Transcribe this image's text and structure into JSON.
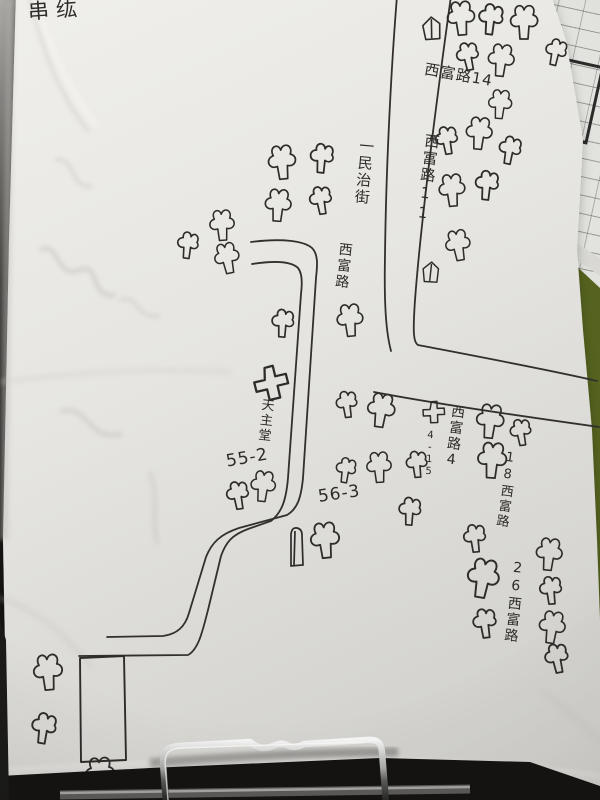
{
  "map": {
    "corner_note": "串纮",
    "labels": {
      "xifu_14": "西富路14",
      "minzhi_street": "一民治街",
      "xifu_11": "西富路11",
      "xifu_road": "西富路",
      "catholic_church": "天主堂",
      "addr_55_2": "55-2",
      "addr_56_3": "56-3",
      "addr_4_15": "4-15",
      "xifu_4": "西富路4",
      "xifu_18": "18西富路",
      "xifu_26": "26西富路"
    }
  },
  "background_form": {
    "code": "39219",
    "code2": "113",
    "note": "存法案",
    "note2": "台灣",
    "row_numbers": "14 15 16 17"
  },
  "colors": {
    "paper": "#e7e6e2",
    "ink": "#2e2c2a",
    "table_green": "#55631f",
    "background_dark": "#171614",
    "clip_metal": "#c9c9c9"
  }
}
